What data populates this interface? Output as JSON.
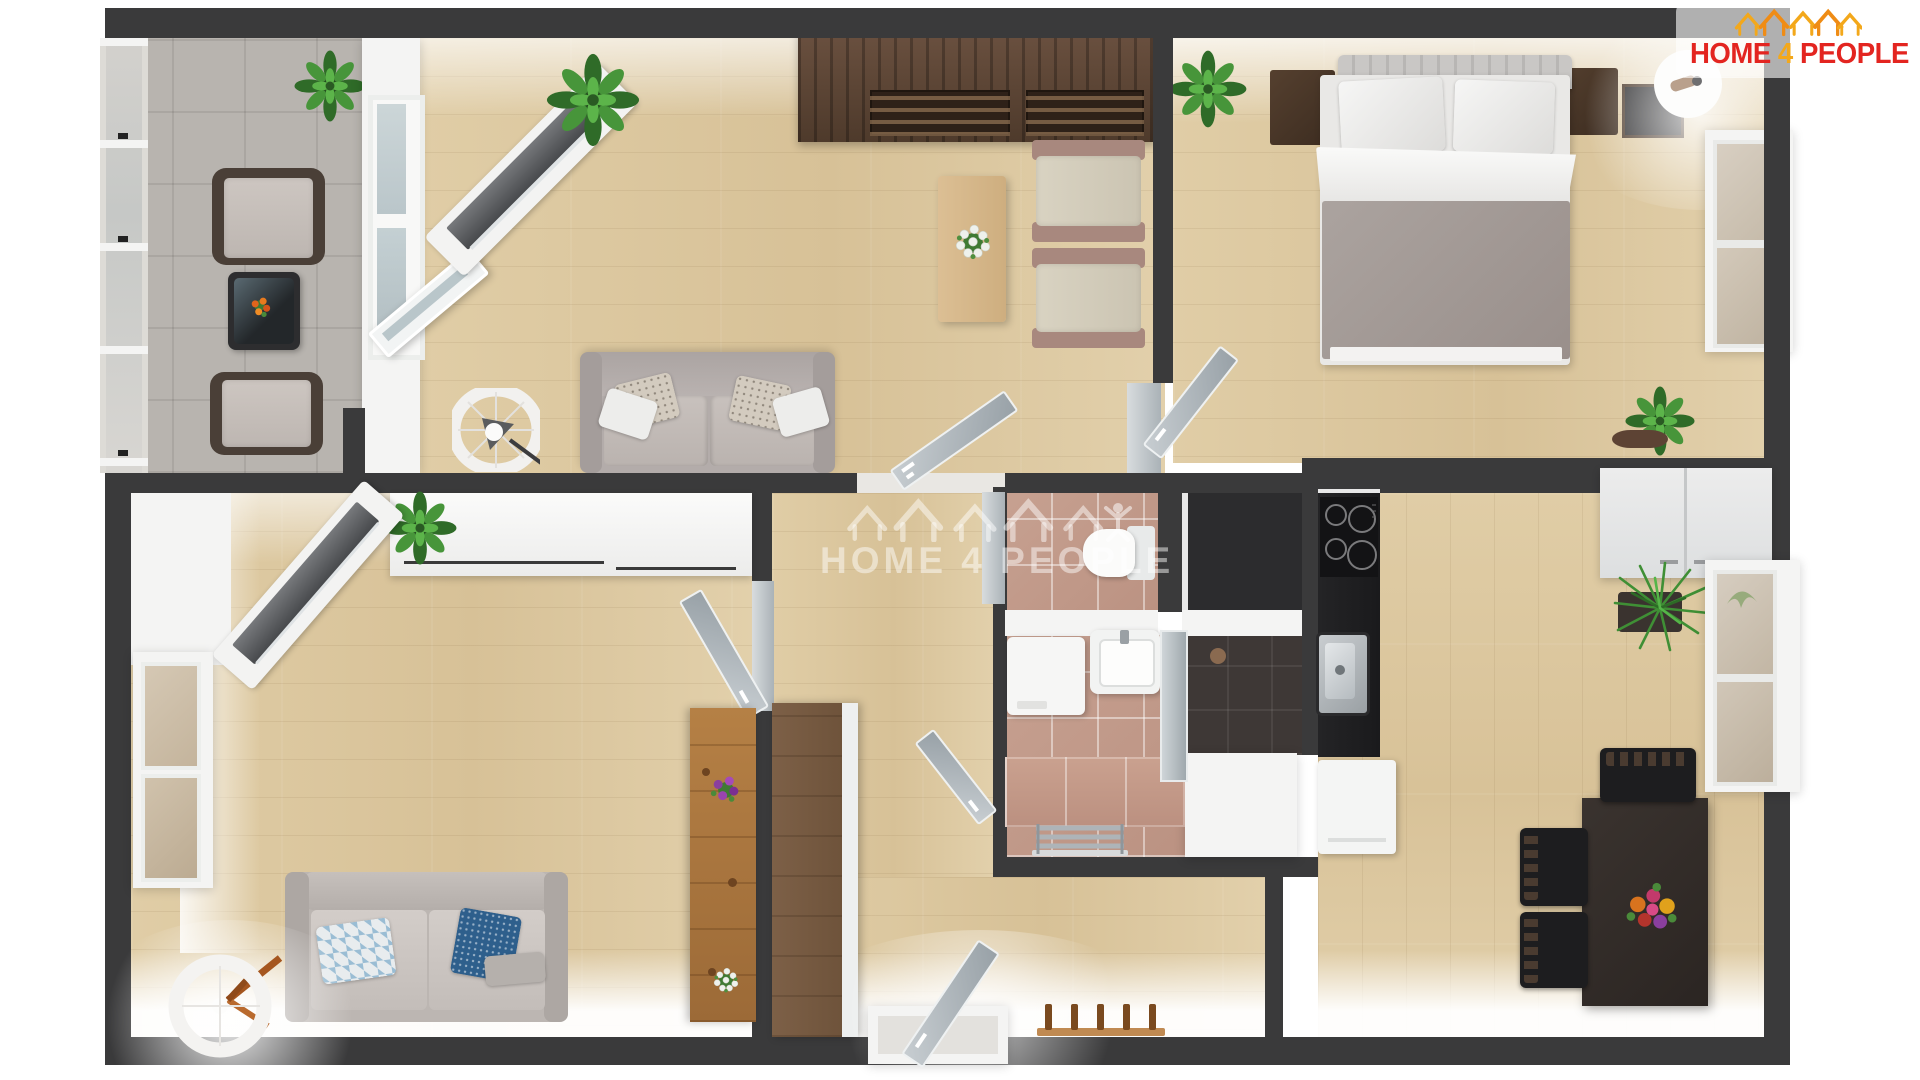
{
  "logo": {
    "home": "HOME",
    "four": "4",
    "people": "PEOPLE",
    "red": "#e32520",
    "gold": "#f3a81b"
  },
  "watermark": {
    "home": "HOME",
    "four": "4",
    "people": "PEOPLE"
  },
  "palette": {
    "wall": "#3a3a3b",
    "floor_wood": "#dcc8a1",
    "balcony_tile": "#b8b4af",
    "bath_tile": "#c39c8d",
    "shower_tile": "#3e3836",
    "counter_black": "#1e1e20",
    "accent_red": "#e32520",
    "accent_gold": "#f3a81b"
  }
}
